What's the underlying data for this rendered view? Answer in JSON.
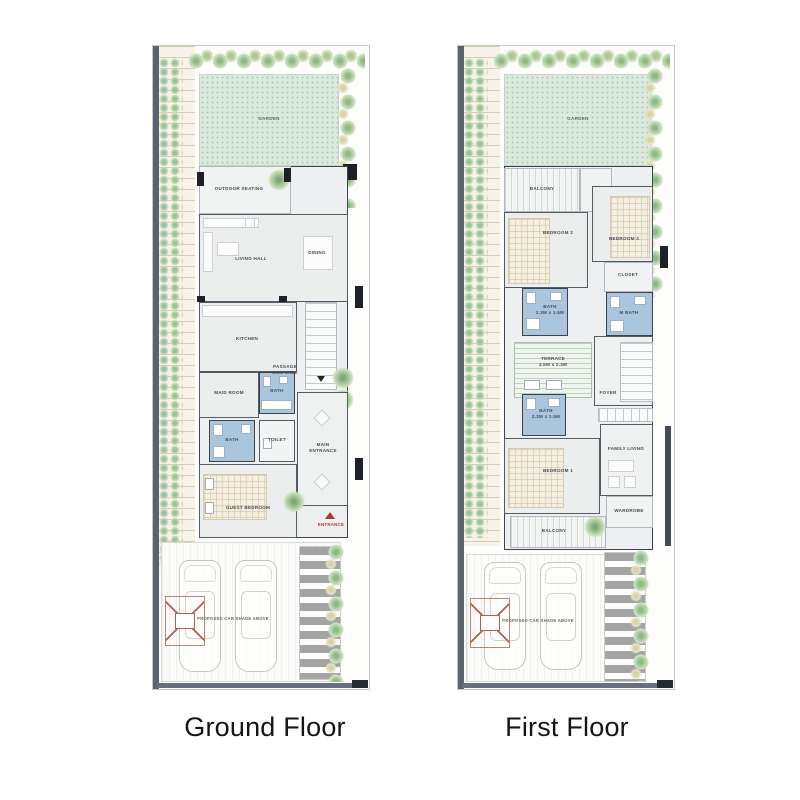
{
  "captions": {
    "ground": "Ground Floor",
    "first": "First Floor"
  },
  "palette": {
    "boundary_wall": "#5d6273",
    "garden_green": "#dce9df",
    "bath_blue": "#aac6de",
    "wall_dark": "#3e424b",
    "accent_red": "#b3392f"
  },
  "ground_floor": {
    "labels": {
      "garden": "GARDEN",
      "outdoor_seating": "OUTDOOR SEATING",
      "living_hall": "LIVING HALL",
      "dining": "DINING",
      "kitchen": "KITCHEN",
      "passage": "PASSAGE\n1.2M WIDE",
      "maid_room": "MAID ROOM",
      "bath_upper": "BATH",
      "bath_lower": "BATH",
      "toilet": "TOILET",
      "main_entrance": "MAIN\nENTRANCE",
      "guest_bedroom": "GUEST BEDROOM",
      "entrance": "ENTRANCE",
      "car_shade": "PROPOSED CAR SHADE ABOVE"
    }
  },
  "first_floor": {
    "labels": {
      "garden": "GARDEN",
      "balcony_top": "BALCONY",
      "bedroom_2": "BEDROOM 2",
      "bedroom_3": "BEDROOM 3",
      "closet": "CLOSET",
      "bath_top": "BATH\n2.3M x 1.5M",
      "master_bath": "M BATH",
      "terrace": "TERRACE\n3.5M x 2.3M",
      "foyer": "FOYER",
      "bath_bottom": "BATH\n2.3M x 1.5M",
      "bedroom_1": "BEDROOM 1",
      "family_living": "FAMILY LIVING",
      "wardrobe": "WARDROBE",
      "balcony_bottom": "BALCONY",
      "car_shade": "PROPOSED CAR SHADE ABOVE"
    }
  }
}
